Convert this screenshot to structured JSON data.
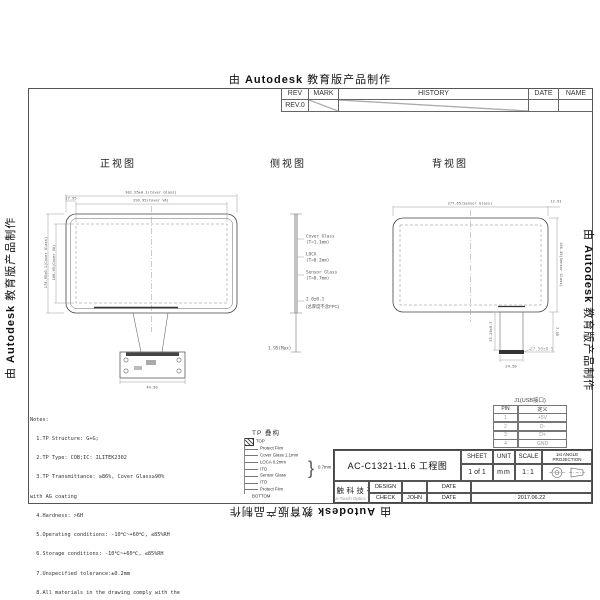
{
  "banner": {
    "prefix": "由",
    "brand": "Autodesk",
    "suffix": "教育版产品制作"
  },
  "rev_table": {
    "headers": [
      "REV",
      "MARK",
      "HISTORY",
      "DATE",
      "NAME"
    ],
    "rev0": "REV.0"
  },
  "views": {
    "front": {
      "label": "正视图",
      "dims": {
        "top_outer": "301.95±0.1(Cover Glass)",
        "top_inner": "293.95(Cover VA)",
        "corner": "27.95",
        "left_outer": "174.95±0.1(Cover Glass)",
        "left_inner": "166.95(Cover VA)",
        "pcb_width": "44.50"
      }
    },
    "side": {
      "label": "侧视图",
      "layers": [
        {
          "name": "Cover Glass",
          "thickness": "(T=1.1mm)"
        },
        {
          "name": "LOCA",
          "thickness": "(T=0.2mm)"
        },
        {
          "name": "Sensor Glass",
          "thickness": "(T=0.7mm)"
        }
      ],
      "total": "2.0±0.1",
      "total_note": "(总厚度不含FPC)",
      "max": "1.95(Max)"
    },
    "back": {
      "label": "背视图",
      "dims": {
        "top": "277.65(Sensor Glass)",
        "top_right": "12.91",
        "right": "166.35(Sensor Glass)",
        "tail_length": "55.24±0.5",
        "tail_width": "24.50",
        "tail_offset": "7.95",
        "connector": "27.50±0.5"
      }
    }
  },
  "notes": {
    "lines": [
      "Notes:",
      "  1.TP Structure: G+G;",
      "  2.TP Type: COB;IC: ILITEK2302",
      "  3.TP Transmittance: ≥86%, Cover Glass≥90%",
      "with AG coating",
      "  4.Hardness: >6H",
      "  5.Operating conditions: -10℃~+60℃, ≤85%RH",
      "  6.Storage conditions: -10℃~+60℃, ≤85%RH",
      "  7.Unspecified tolerance:±0.2mm",
      "  8.All materials in the drawing comply with the",
      "RoSH"
    ]
  },
  "stackup": {
    "title": "TP 叠构",
    "top": "TOP",
    "bottom": "BOTTOM",
    "layers": [
      "Protect Film",
      "Cover Glass 1.1mm",
      "LOCA 0.2mm",
      "ITO",
      "Sensor Glass",
      "ITO",
      "Protect Film"
    ],
    "brace_value": "0.7mm"
  },
  "pin_table": {
    "title": "J1(USB接口)",
    "headers": [
      "PIN",
      "定义"
    ],
    "rows": [
      [
        "1",
        "+5V"
      ],
      [
        "2",
        "D-"
      ],
      [
        "3",
        "D+"
      ],
      [
        "4",
        "GND"
      ]
    ]
  },
  "title_block": {
    "title": "AC-C1321-11.6 工程图",
    "sheet_label": "SHEET",
    "sheet": "1 of 1",
    "unit_label": "UNIT",
    "unit": "mm",
    "scale_label": "SCALE",
    "scale": "1:1",
    "projection_label_1": "1st ANGLE",
    "projection_label_2": "PROJECTION",
    "design_label": "DESIGN",
    "check_label": "CHECK",
    "date_label": "DATE",
    "checker": "JOHN",
    "date": "2017.06.22",
    "company_cn": "深圳市安触科技有限公司",
    "company_en": "ShenZhen An-Touch Optics Tech Co.,Ltd"
  }
}
